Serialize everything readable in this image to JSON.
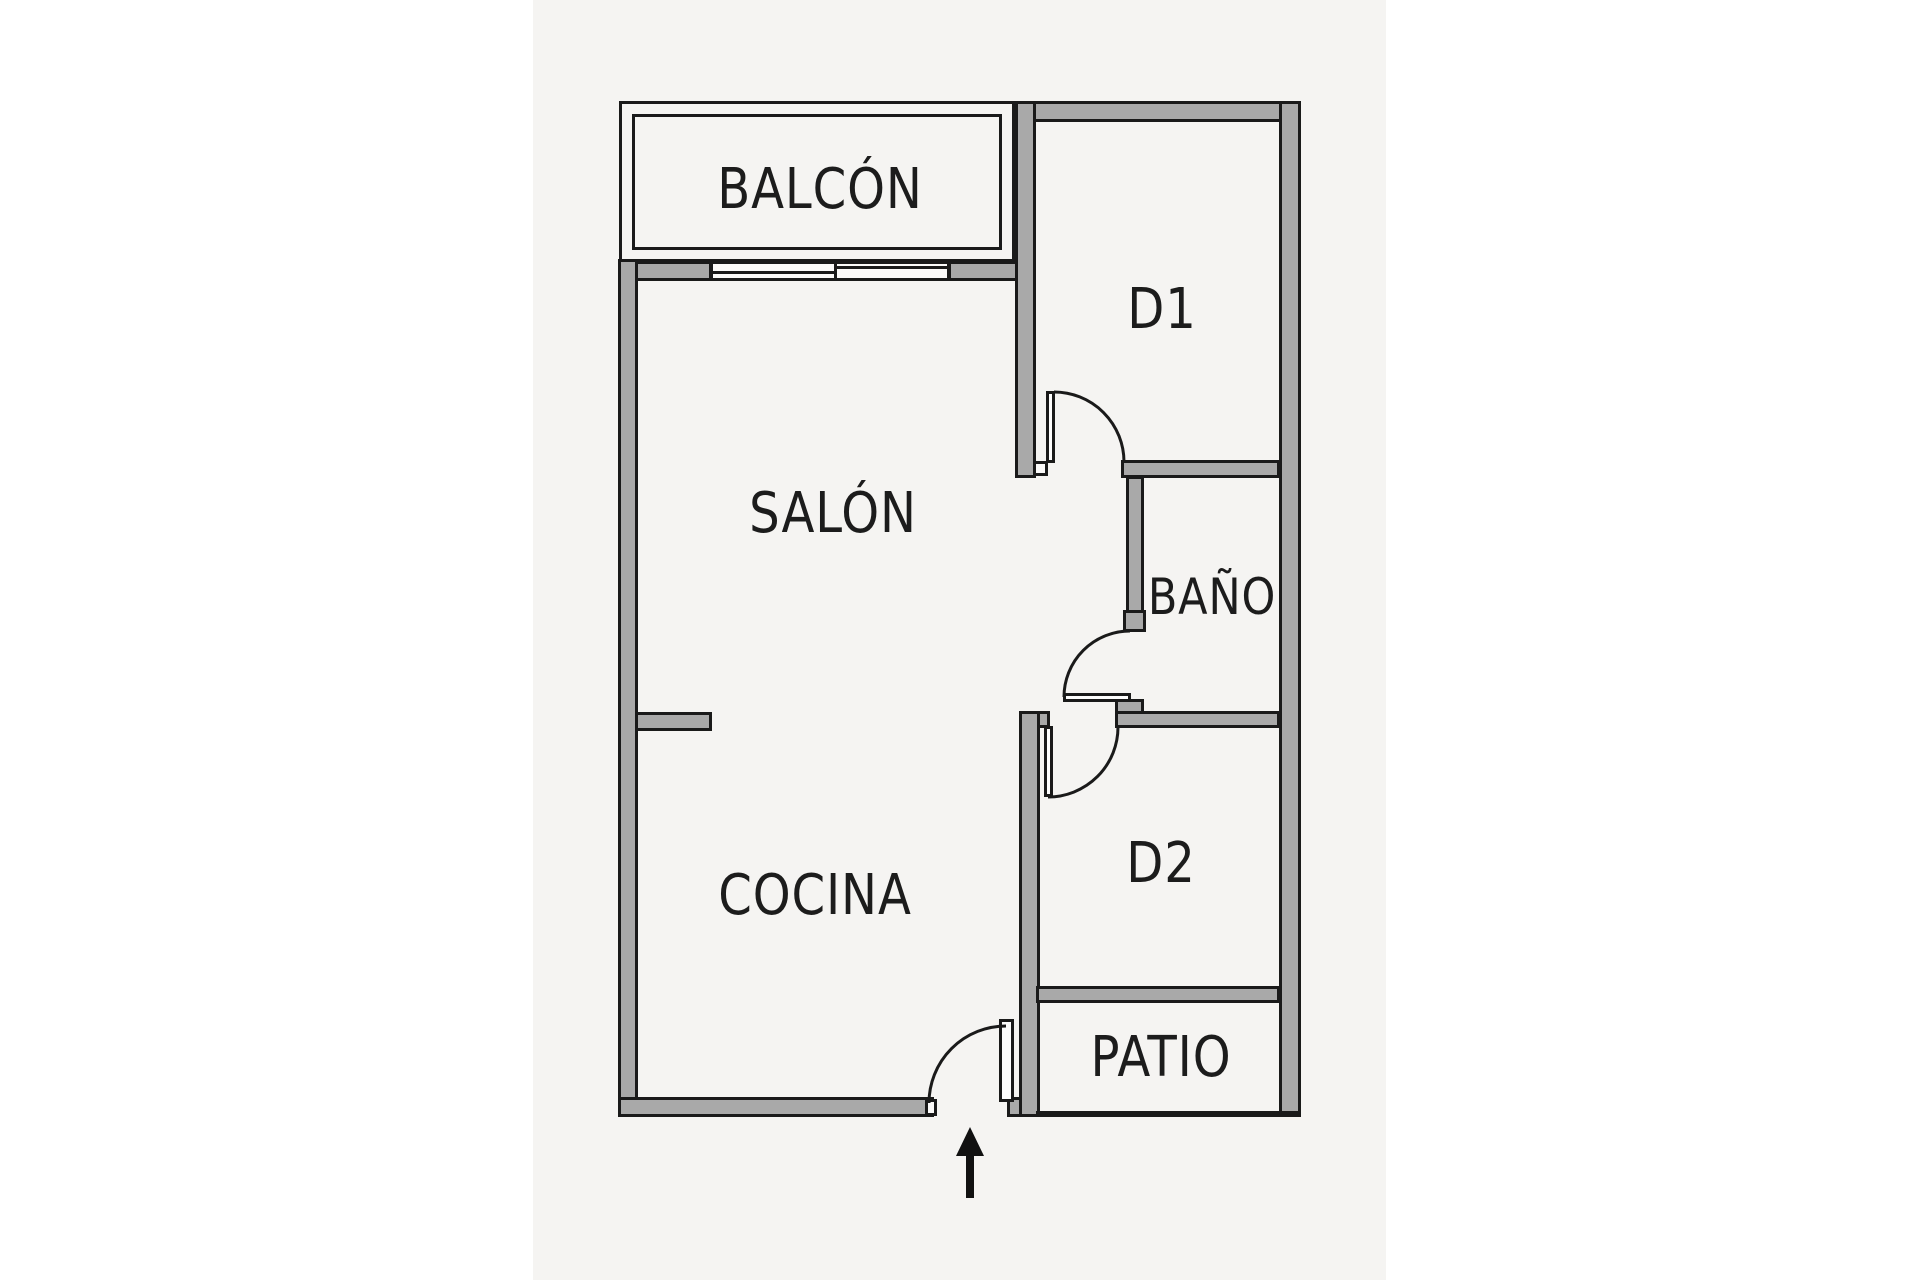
{
  "plan": {
    "rooms": {
      "balcon": {
        "label": "BALCÓN"
      },
      "salon": {
        "label": "SALÓN"
      },
      "cocina": {
        "label": "COCINA"
      },
      "d1": {
        "label": "D1"
      },
      "bano": {
        "label": "BAÑO"
      },
      "d2": {
        "label": "D2"
      },
      "patio": {
        "label": "PATIO"
      }
    },
    "icons": {
      "entrance_arrow": "up-arrow"
    },
    "colors": {
      "wall_fill": "#a9a9a9",
      "line": "#1a1a1a",
      "paper": "#f5f4f2",
      "page": "#ffffff",
      "text": "#1c1c1c"
    }
  }
}
